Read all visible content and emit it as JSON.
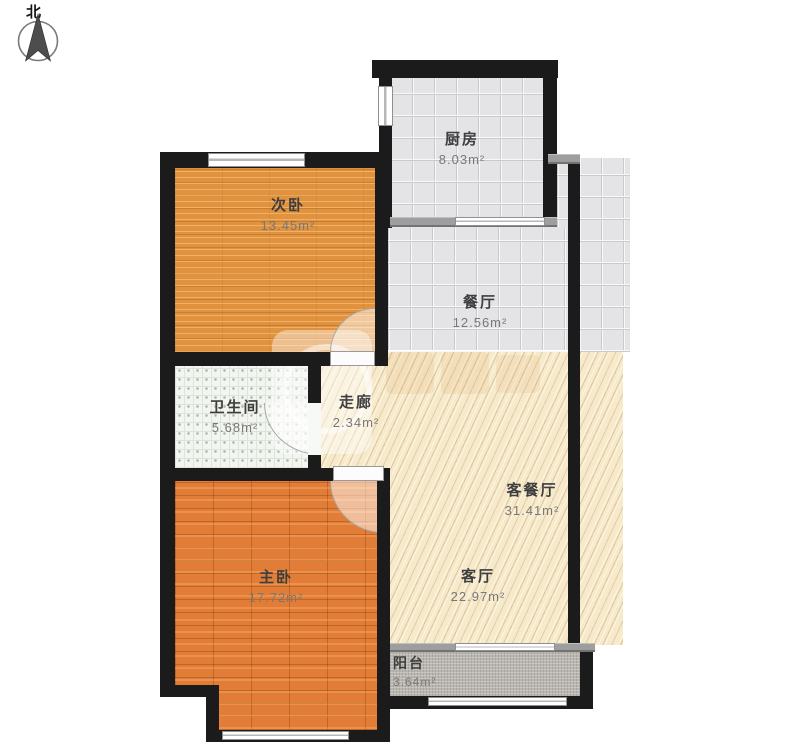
{
  "compass": {
    "label": "北"
  },
  "rooms": [
    {
      "name": "厨房",
      "area": "8.03m²"
    },
    {
      "name": "次卧",
      "area": "13.45m²"
    },
    {
      "name": "餐厅",
      "area": "12.56m²"
    },
    {
      "name": "卫生间",
      "area": "5.68m²"
    },
    {
      "name": "走廊",
      "area": "2.34m²"
    },
    {
      "name": "客餐厅",
      "area": "31.41m²"
    },
    {
      "name": "客厅",
      "area": "22.97m²"
    },
    {
      "name": "主卧",
      "area": "17.72m²"
    },
    {
      "name": "阳台",
      "area": "3.64m²"
    }
  ],
  "colors": {
    "wall": "#1b1b1b",
    "bedroom2_wood": "#e0923f",
    "master_wood": "#e17d36",
    "tile_gray": "#e4e4e7",
    "living_hatch": "#f7eacb",
    "bathroom_tile": "#f3f5f1",
    "balcony_gray": "#b9b6b0"
  }
}
